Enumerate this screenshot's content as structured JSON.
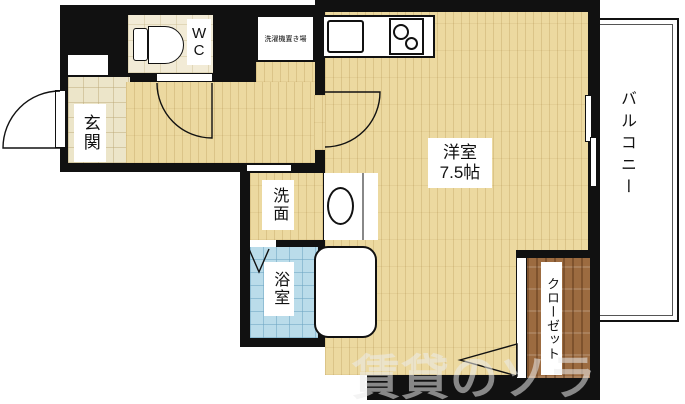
{
  "plan": {
    "title": "1K apartment floor plan",
    "rooms": {
      "entrance": {
        "label": "玄関"
      },
      "wc": {
        "label": "WC"
      },
      "laundry": {
        "label": "洗濯機置き場"
      },
      "washroom": {
        "label": "洗面"
      },
      "bathroom": {
        "label": "浴室"
      },
      "main_room": {
        "label": "洋室",
        "size": "7.5帖"
      },
      "closet": {
        "label": "クローゼット"
      },
      "balcony": {
        "label": "バルコニー"
      }
    },
    "fixtures": {
      "toilet": "toilet-icon",
      "kitchen_sink": "kitchen-sink-icon",
      "stove": "stove-burner-icon",
      "washbasin": "washbasin-icon",
      "bathtub": "bathtub-icon",
      "sliding_window": "sliding-window-icon"
    },
    "watermark": "賃貸のソラ",
    "colors": {
      "wall": "#111111",
      "flooring": "#ecd9a0",
      "entrance_tile": "#ece5c9",
      "bath_tile": "#badcea",
      "closet_wood": "#9c6b40",
      "fixture_white": "#ffffff"
    }
  }
}
